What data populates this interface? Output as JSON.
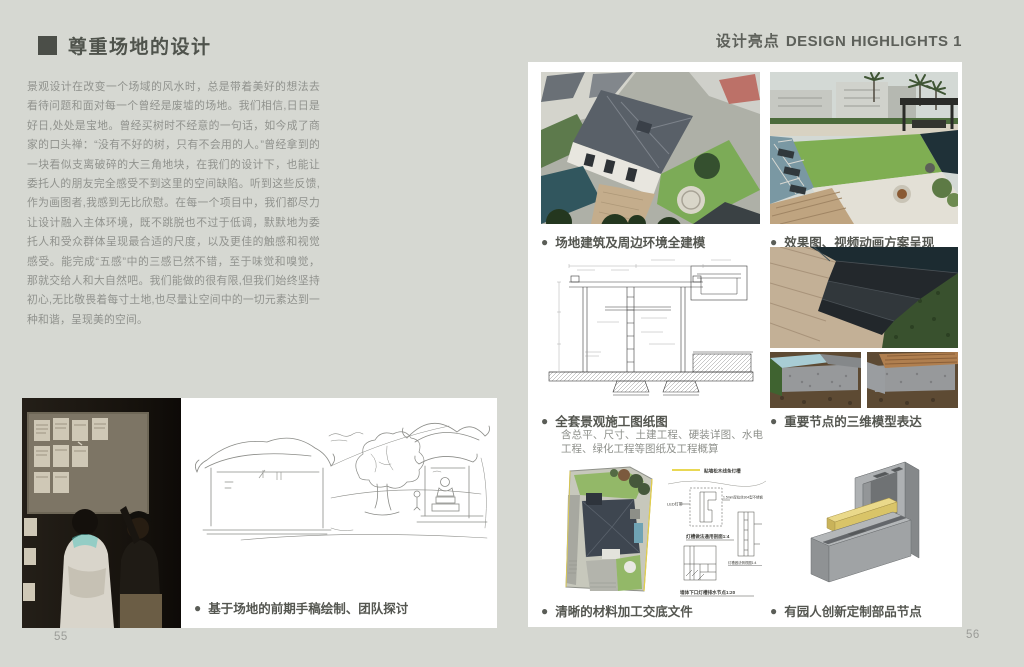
{
  "colors": {
    "background": "#d6d8d2",
    "panel": "#ffffff",
    "title_text": "#4f534c",
    "body_text": "#90928d",
    "caption_text": "#545650",
    "accent_yellow": "#e6d23c"
  },
  "icons": {
    "bullet": "●",
    "title_square": "square-marker"
  },
  "left_page": {
    "title": "尊重场地的设计",
    "paragraph": "景观设计在改变一个场域的风水时，总是带着美好的想法去看待问题和面对每一个曾经是废墟的场地。我们相信,日日是好日,处处是宝地。曾经买树时不经意的一句话，如今成了商家的口头禅：“没有不好的树，只有不会用的人。”曾经拿到的一块看似支离破碎的大三角地块，在我们的设计下，也能让委托人的朋友完全感受不到这里的空间缺陷。听到这些反馈,作为画图者,我感到无比欣慰。在每一个项目中，我们都尽力让设计融入主体环境，既不跳脱也不过于低调，默默地为委托人和受众群体呈现最合适的尺度，以及更佳的触感和视觉感受。能完成“五感”中的三感已然不错，至于味觉和嗅觉，那就交给人和大自然吧。我们能做的很有限,但我们始终坚持初心,无比敬畏着每寸土地,也尽量让空间中的一切元素达到一种和谐，呈现美的空间。",
    "figure_caption": "基于场地的前期手稿绘制、团队探讨",
    "page_number": "55"
  },
  "right_page": {
    "header_cn": "设计亮点",
    "header_en": "DESIGN HIGHLIGHTS 1",
    "page_number": "56",
    "captions": {
      "modeling": "场地建筑及周边环境全建模",
      "render": "效果图、视频动画方案呈现",
      "drawings": "全套景观施工图纸图",
      "drawings_note": "含总平、尺寸、土建工程、硬装详图、水电工程、绿化工程等图纸及工程概算",
      "nodes3d": "重要节点的三维模型表达",
      "materials": "清晰的材料加工交底文件",
      "custom_parts": "有园人创新定制部品节点"
    },
    "detail_labels": {
      "legend": "贴墙松木线条灯槽",
      "led": "LED灯带",
      "steel": "1.5mm厚拉丝304型不锈钢",
      "section1": "灯槽做法通用剖面1:4",
      "section2": "灯槽做法侧视图1:4",
      "section3": "墙体下口灯槽排水节点1:20"
    }
  }
}
